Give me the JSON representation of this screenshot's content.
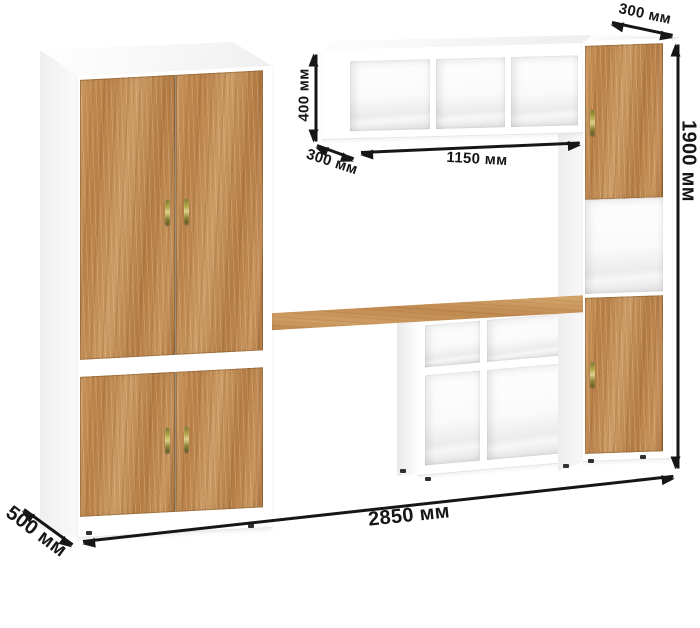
{
  "annotations": {
    "cabinet_top_depth": "300 мм",
    "total_height": "1900 мм",
    "shelf_height": "400 мм",
    "shelf_width": "1150 мм",
    "shelf_depth": "300 мм",
    "total_width": "2850 мм",
    "wardrobe_depth": "500 мм"
  },
  "colors": {
    "wood": "#c08a52",
    "carcass": "#ffffff",
    "annotation_text": "#161616",
    "handle_brass": "#b3a648",
    "background": "#ffffff"
  }
}
